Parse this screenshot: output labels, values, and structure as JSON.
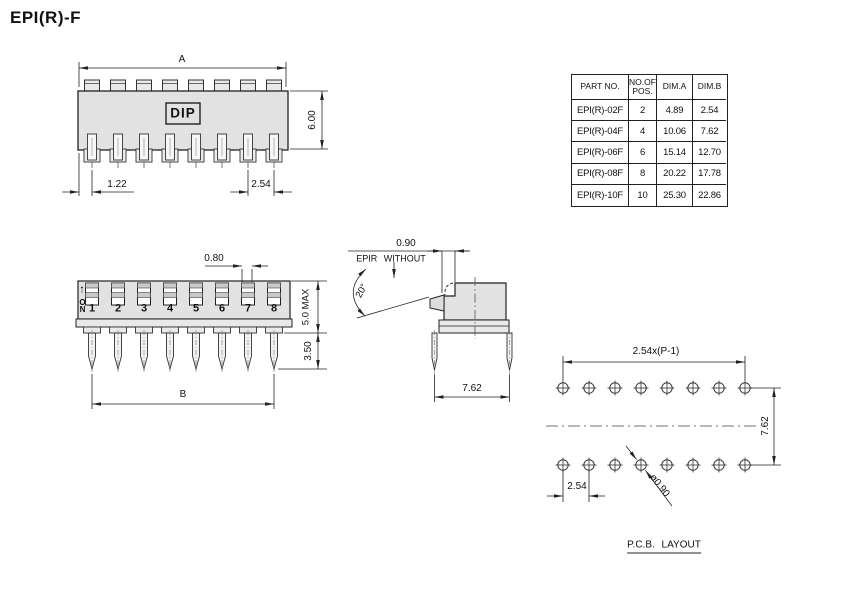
{
  "title": "EPI(R)-F",
  "colors": {
    "line": "#222222",
    "body_fill": "#e2e2e2",
    "background": "#ffffff"
  },
  "table": {
    "headers": [
      "PART NO.",
      "NO.OF POS.",
      "DIM.A",
      "DIM.B"
    ],
    "rows": [
      [
        "EPI(R)-02F",
        "2",
        "4.89",
        "2.54"
      ],
      [
        "EPI(R)-04F",
        "4",
        "10.06",
        "7.62"
      ],
      [
        "EPI(R)-06F",
        "6",
        "15.14",
        "12.70"
      ],
      [
        "EPI(R)-08F",
        "8",
        "20.22",
        "17.78"
      ],
      [
        "EPI(R)-10F",
        "10",
        "25.30",
        "22.86"
      ]
    ]
  },
  "top_view": {
    "dim_width_label": "A",
    "dim_height": "6.00",
    "dim_first_pin": "1.22",
    "dim_pitch": "2.54",
    "dip_label": "DIP",
    "tab_count": 8,
    "pin_count": 8
  },
  "front_view": {
    "dim_slot_width": "0.80",
    "dim_body_height": "5.0 MAX",
    "dim_pin_length": "3.50",
    "dim_span_label": "B",
    "on_marker": {
      "arrow": "↑",
      "label": "ON"
    },
    "switch_labels": [
      "1",
      "2",
      "3",
      "4",
      "5",
      "6",
      "7",
      "8"
    ]
  },
  "side_view": {
    "dim_actuator": "0.90",
    "note": "EPIR WITHOUT",
    "dim_angle": "20°",
    "dim_pin_spacing": "7.62"
  },
  "pcb_layout": {
    "dim_span": "2.54x(P-1)",
    "dim_row_spacing": "7.62",
    "dim_pitch": "2.54",
    "dim_hole_dia": "ø0.90",
    "caption": "P.C.B. LAYOUT",
    "hole_columns": 8,
    "hole_rows": 2
  }
}
